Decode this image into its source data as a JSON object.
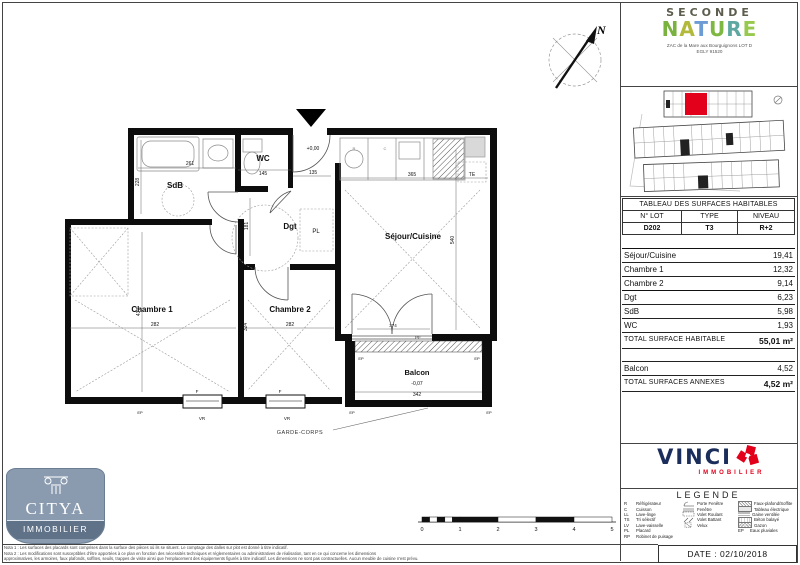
{
  "brand": {
    "red": "#e2001a",
    "vinci_navy": "#1b2d5b"
  },
  "header": {
    "brand_line1": "SECONDE",
    "nature_letters": [
      {
        "ch": "N",
        "color": "#79b23f"
      },
      {
        "ch": "A",
        "color": "#b3b93b"
      },
      {
        "ch": "T",
        "color": "#6d9cd4"
      },
      {
        "ch": "U",
        "color": "#7fb743"
      },
      {
        "ch": "R",
        "color": "#5fa8a2"
      },
      {
        "ch": "E",
        "color": "#97c94f"
      }
    ],
    "address1": "ZAC de la Mare aux Bourguignons LOT D",
    "address2": "EGLY 91520"
  },
  "surface_table": {
    "title": "TABLEAU DES SURFACES HABITABLES",
    "col_headers": [
      "N° LOT",
      "TYPE",
      "NIVEAU"
    ],
    "lot": "D202",
    "type": "T3",
    "niveau": "R+2",
    "rows": [
      {
        "label": "Séjour/Cuisine",
        "value": "19,41"
      },
      {
        "label": "Chambre 1",
        "value": "12,32"
      },
      {
        "label": "Chambre 2",
        "value": "9,14"
      },
      {
        "label": "Dgt",
        "value": "6,23"
      },
      {
        "label": "SdB",
        "value": "5,98"
      },
      {
        "label": "WC",
        "value": "1,93"
      }
    ],
    "total_label": "TOTAL SURFACE HABITABLE",
    "total_value": "55,01 m²",
    "annex_rows": [
      {
        "label": "Balcon",
        "value": "4,52"
      }
    ],
    "annex_total_label": "TOTAL SURFACES ANNEXES",
    "annex_total_value": "4,52 m²"
  },
  "plan": {
    "rooms": {
      "sdb": "SdB",
      "wc": "WC",
      "dgt": "Dgt",
      "pl": "PL",
      "sejour": "Séjour/Cuisine",
      "ch1": "Chambre 1",
      "ch2": "Chambre 2",
      "balcon": "Balcon"
    },
    "levels": {
      "entry": "+0,00",
      "balcon": "-0,07"
    },
    "dims": {
      "sdb_w": "261",
      "sdb_h": "228",
      "wc_w": "145",
      "entry_w": "135",
      "sejour_w": "365",
      "sejour_h": "540",
      "dgt_h": "181",
      "ch1_w": "282",
      "ch1_h": "437",
      "ch2_w": "282",
      "ch2_h": "324",
      "pf_w": "374",
      "balcon_w": "342"
    },
    "tags": {
      "te": "TE",
      "f": "F",
      "vr": "VR",
      "pf": "PF",
      "ep": "EP",
      "garde_corps": "GARDE-CORPS",
      "r": "R",
      "c": "C"
    },
    "compass": "N"
  },
  "legend": {
    "title": "LEGENDE",
    "col1": [
      {
        "key": "R",
        "label": "Réfrigérateur"
      },
      {
        "key": "C",
        "label": "Cuisson"
      },
      {
        "key": "LL",
        "label": "Lave-linge"
      },
      {
        "key": "TS",
        "label": "Tri sélectif"
      },
      {
        "key": "LV",
        "label": "Lave-vaisselle"
      },
      {
        "key": "PL",
        "label": "Placard"
      },
      {
        "key": "RP",
        "label": "Robinet de puisage"
      }
    ],
    "col2": [
      {
        "label": "Porte Fenêtre"
      },
      {
        "label": "Fenêtre"
      },
      {
        "label": "Volet Roulant"
      },
      {
        "label": "Volet Battant"
      },
      {
        "label": "Velux"
      }
    ],
    "col3": [
      {
        "label": "Faux-plafond/Soffite"
      },
      {
        "label": "Tableau électrique"
      },
      {
        "label": "Gaine ventilée"
      },
      {
        "label": "Béton balayé"
      },
      {
        "label": "Gazon"
      },
      {
        "key": "EP",
        "label": "Eaux pluviales"
      }
    ]
  },
  "vinci": {
    "name": "VINCI",
    "sub": "IMMOBILIER"
  },
  "citya": {
    "name": "CITYA",
    "sub": "IMMOBILIER"
  },
  "footer": {
    "date": "DATE : 02/10/2018",
    "nota1": "Nota 1 : Les surfaces des placards sont comprises dans la surface des pièces où ils se situent. Le comptage des dalles sur plot est donné à titre indicatif.",
    "nota2": "Nota 2 : Les modifications sont susceptibles d'être apportées à ce plan en fonction des nécessités techniques et réglementaires ou administratives de réalisation, tant en ce qui concerne les dimensions",
    "nota3": "approximatives, les armoires, faux plafonds, soffites, seuils, trappes de visite ainsi que l'emplacement des équipements figurés à titre indicatif. Les dimensions ne sont pas contractuelles. Aucun meuble de cuisine n'est prévu."
  },
  "scalebar": {
    "ticks": [
      "0",
      "1",
      "2",
      "3",
      "4",
      "5"
    ]
  }
}
